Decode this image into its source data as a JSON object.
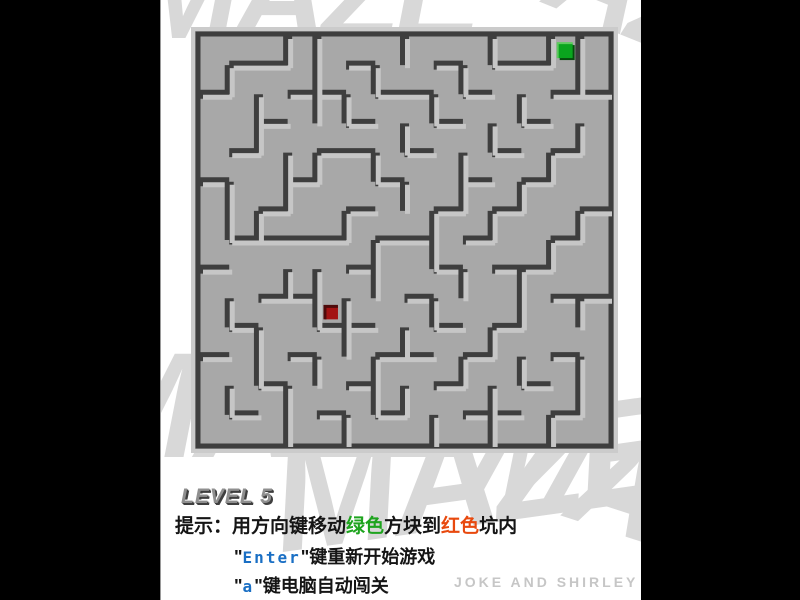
{
  "window": {
    "background_color": "#000000",
    "content_background": "#ffffff"
  },
  "watermark": {
    "text": "MAZE",
    "color": "#d8d8d8"
  },
  "maze": {
    "floor_color": "#a8a8a8",
    "frame_light": "#cbcbcb",
    "frame_dark": "#3e3e3e",
    "wall_dark": "#3e3e3e",
    "wall_light": "#c6c6c6",
    "grid": {
      "cols": 14,
      "rows": 14
    },
    "h_walls": [
      [
        1,
        1,
        3
      ],
      [
        1,
        5,
        6
      ],
      [
        1,
        8,
        9
      ],
      [
        1,
        10,
        12
      ],
      [
        2,
        0,
        1
      ],
      [
        2,
        3,
        5
      ],
      [
        2,
        6,
        8
      ],
      [
        2,
        9,
        10
      ],
      [
        2,
        12,
        14
      ],
      [
        3,
        2,
        3
      ],
      [
        3,
        5,
        6
      ],
      [
        3,
        8,
        9
      ],
      [
        3,
        11,
        12
      ],
      [
        4,
        1,
        2
      ],
      [
        4,
        4,
        6
      ],
      [
        4,
        7,
        8
      ],
      [
        4,
        10,
        11
      ],
      [
        4,
        12,
        13
      ],
      [
        5,
        0,
        1
      ],
      [
        5,
        3,
        4
      ],
      [
        5,
        6,
        7
      ],
      [
        5,
        9,
        10
      ],
      [
        5,
        11,
        12
      ],
      [
        6,
        2,
        3
      ],
      [
        6,
        5,
        6
      ],
      [
        6,
        8,
        9
      ],
      [
        6,
        10,
        11
      ],
      [
        6,
        13,
        14
      ],
      [
        7,
        1,
        5
      ],
      [
        7,
        6,
        8
      ],
      [
        7,
        9,
        10
      ],
      [
        7,
        12,
        13
      ],
      [
        8,
        0,
        1
      ],
      [
        8,
        5,
        6
      ],
      [
        8,
        8,
        9
      ],
      [
        8,
        10,
        12
      ],
      [
        9,
        2,
        4
      ],
      [
        9,
        7,
        8
      ],
      [
        9,
        12,
        14
      ],
      [
        10,
        1,
        2
      ],
      [
        10,
        4,
        6
      ],
      [
        10,
        8,
        9
      ],
      [
        10,
        10,
        11
      ],
      [
        11,
        0,
        1
      ],
      [
        11,
        3,
        4
      ],
      [
        11,
        6,
        8
      ],
      [
        11,
        9,
        10
      ],
      [
        11,
        12,
        13
      ],
      [
        12,
        2,
        3
      ],
      [
        12,
        5,
        6
      ],
      [
        12,
        8,
        9
      ],
      [
        12,
        11,
        12
      ],
      [
        13,
        1,
        2
      ],
      [
        13,
        4,
        5
      ],
      [
        13,
        6,
        7
      ],
      [
        13,
        9,
        11
      ],
      [
        13,
        12,
        13
      ]
    ],
    "v_walls": [
      [
        1,
        1,
        2
      ],
      [
        1,
        5,
        7
      ],
      [
        1,
        9,
        10
      ],
      [
        1,
        12,
        13
      ],
      [
        2,
        2,
        4
      ],
      [
        2,
        6,
        7
      ],
      [
        2,
        10,
        12
      ],
      [
        3,
        0,
        1
      ],
      [
        3,
        4,
        6
      ],
      [
        3,
        8,
        9
      ],
      [
        3,
        12,
        14
      ],
      [
        4,
        0,
        3
      ],
      [
        4,
        4,
        5
      ],
      [
        4,
        8,
        10
      ],
      [
        4,
        11,
        12
      ],
      [
        5,
        2,
        3
      ],
      [
        5,
        6,
        7
      ],
      [
        5,
        9,
        11
      ],
      [
        5,
        13,
        14
      ],
      [
        6,
        1,
        2
      ],
      [
        6,
        4,
        5
      ],
      [
        6,
        7,
        9
      ],
      [
        6,
        11,
        13
      ],
      [
        7,
        0,
        1
      ],
      [
        7,
        3,
        4
      ],
      [
        7,
        5,
        6
      ],
      [
        7,
        10,
        11
      ],
      [
        7,
        12,
        13
      ],
      [
        8,
        2,
        3
      ],
      [
        8,
        6,
        8
      ],
      [
        8,
        9,
        10
      ],
      [
        8,
        13,
        14
      ],
      [
        9,
        1,
        2
      ],
      [
        9,
        4,
        6
      ],
      [
        9,
        8,
        9
      ],
      [
        9,
        11,
        12
      ],
      [
        10,
        0,
        1
      ],
      [
        10,
        3,
        4
      ],
      [
        10,
        6,
        7
      ],
      [
        10,
        10,
        11
      ],
      [
        10,
        12,
        14
      ],
      [
        11,
        2,
        3
      ],
      [
        11,
        5,
        6
      ],
      [
        11,
        8,
        10
      ],
      [
        11,
        11,
        12
      ],
      [
        12,
        0,
        1
      ],
      [
        12,
        4,
        5
      ],
      [
        12,
        7,
        8
      ],
      [
        12,
        13,
        14
      ],
      [
        13,
        0,
        2
      ],
      [
        13,
        3,
        4
      ],
      [
        13,
        6,
        7
      ],
      [
        13,
        9,
        10
      ],
      [
        13,
        11,
        13
      ]
    ],
    "player_block": {
      "label": "green-block",
      "fill": "#0aa51e",
      "edge_light": "#5ecb5e",
      "edge_dark": "#064d0d",
      "cell": [
        12,
        0
      ],
      "size": 15
    },
    "target_pit": {
      "label": "red-pit",
      "fill": "#a31212",
      "inner_shadow": "#4e0a0a",
      "cell": [
        4,
        9
      ],
      "size": 13
    }
  },
  "hud": {
    "level_label": "LEVEL 5",
    "hint": {
      "prefix": "提示：用方向键移动",
      "green_word": "绿色",
      "mid": "方块到",
      "red_word": "红色",
      "suffix": "坑内",
      "green_color": "#1ea41e",
      "red_color": "#e8490e"
    },
    "line_enter": {
      "open_quote": "\"",
      "key": "Enter",
      "close_quote": "\"",
      "rest": "键重新开始游戏",
      "key_color": "#1a6fc4"
    },
    "line_auto": {
      "open_quote": "\"",
      "key": "a",
      "close_quote": "\"",
      "rest": "键电脑自动闯关",
      "key_color": "#1a6fc4"
    },
    "credit": "JOKE AND SHIRLEY"
  }
}
